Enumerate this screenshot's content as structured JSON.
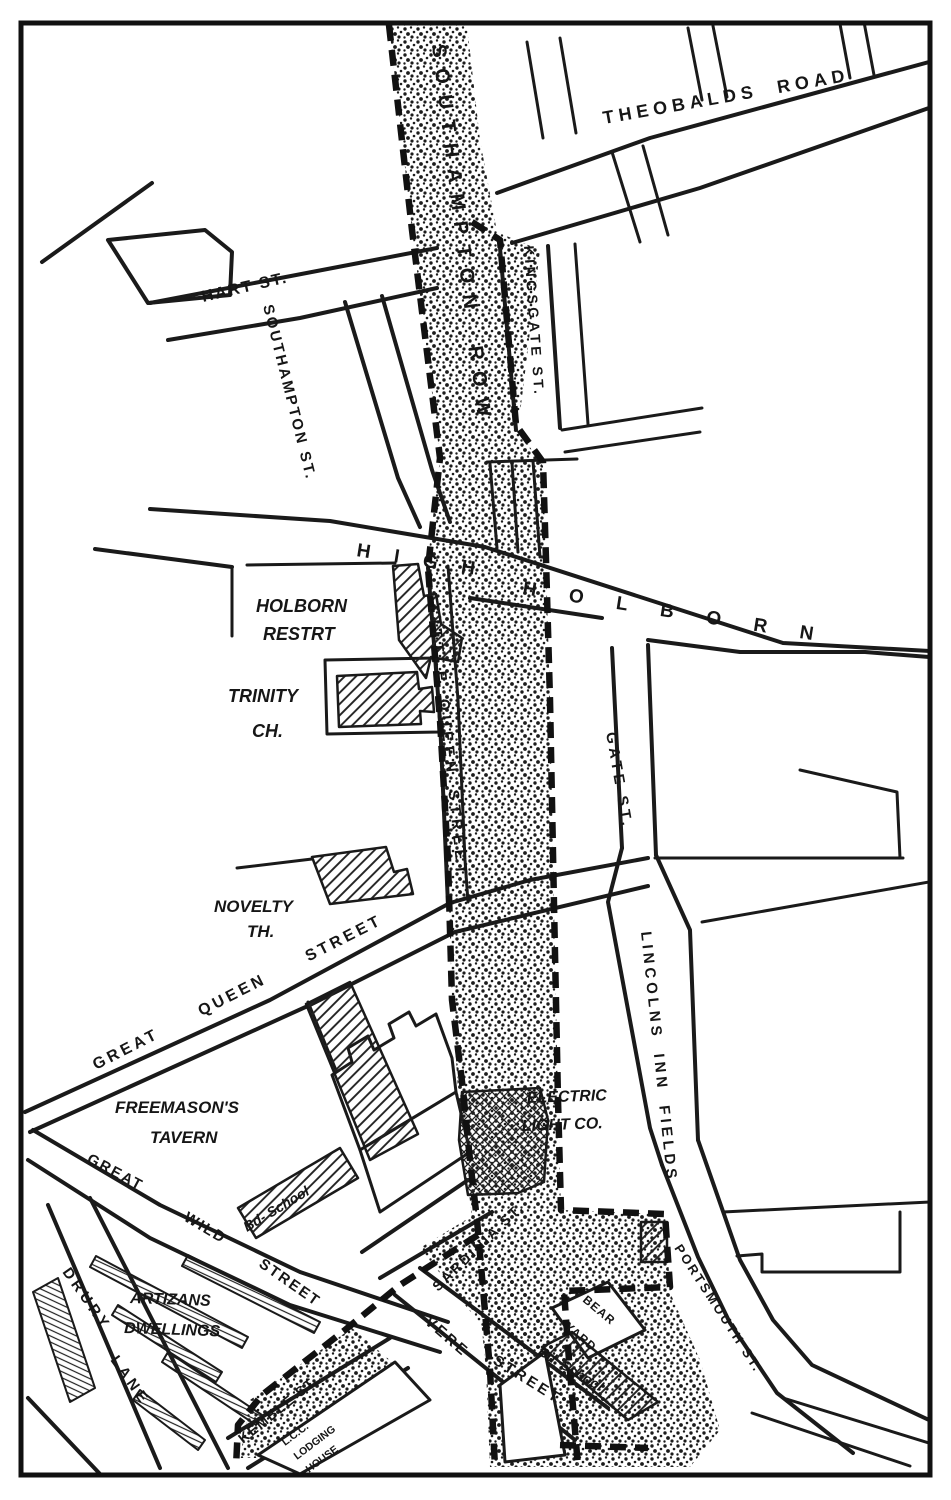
{
  "labels": {
    "theobalds_road": "THEOBALDS  ROAD",
    "southampton_row": "SOUTHAMPTON ROW",
    "hart_st": "HART ST.",
    "southampton_st": "SOUTHAMPTON ST.",
    "kingsgate_st": "KINGSGATE ST.",
    "high": "HIGH",
    "holborn": "HOLBORN",
    "holborn_restrt_line1": "HOLBORN",
    "holborn_restrt_line2": "RESTRT",
    "trinity_ch_line1": "TRINITY",
    "trinity_ch_line2": "CH.",
    "little_queen_street": "LITTLE QUEEN STREET",
    "gate_st": "GATE ST.",
    "novelty_th_line1": "NOVELTY",
    "novelty_th_line2": "TH.",
    "great_queen_street": "GREAT QUEEN STREET",
    "lincolns_inn_fields": "LINCOLNS INN FIELDS",
    "freemasons_tavern_line1": "FREEMASON'S",
    "freemasons_tavern_line2": "TAVERN",
    "electric_light_co_line1": "ELECTRIC",
    "electric_light_co_line2": "LIGHT CO.",
    "bd_school_west": "Bd- School",
    "great_wild_word1": "GREAT",
    "great_wild_word2": "WILD",
    "great_wild_word3": "STREET",
    "artizans_line1": "ARTIZANS",
    "artizans_line2": "DWELLINGS",
    "drury_word1": "DRURY",
    "drury_word2": "LANE",
    "kemble_st": "KEMBLE ST.",
    "sardinia_st": "SARDINIA ST.",
    "vere_word1": "VERE",
    "vere_word2": "STREET",
    "bear_yard_line1": "BEAR",
    "bear_yard_line2": "YARD",
    "bd_school_east": "Bd. School",
    "portsmouth_st": "PORTSMOUTH ST.",
    "lcc_line1": "L.C.C.",
    "lcc_line2": "LODGING",
    "lcc_line3": "HOUSE"
  },
  "colors": {
    "ink": "#1a1a1a",
    "paper": "#ffffff"
  }
}
